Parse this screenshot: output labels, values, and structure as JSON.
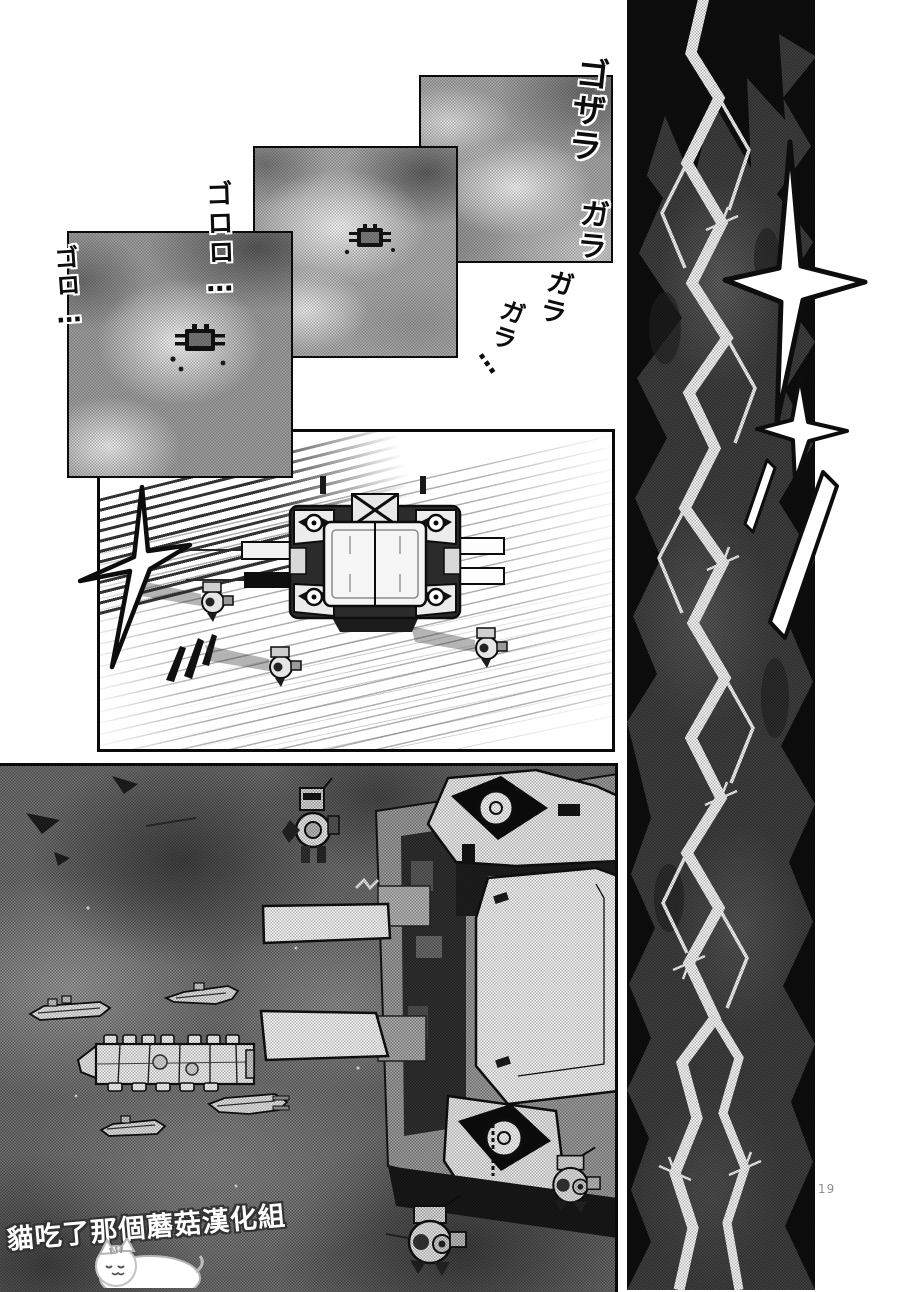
{
  "page": {
    "number": "19"
  },
  "watermark": {
    "text": "貓吃了那個蘑菇漢化組"
  },
  "sfx": {
    "crash_vertical": "ゴザラ",
    "rattle_1": "ガラ",
    "rattle_2": "ガラ",
    "rattle_3": "ガラ",
    "rattle_trail_dots": "…",
    "rumble_long": "ゴロロ…",
    "rumble_short": "ゴロ…"
  },
  "icons": {
    "sparkle": "four-point-star",
    "lightning": "jagged-white-bolt",
    "cargo_container": "top-down-pallet-box",
    "drone": "round-pod-robot",
    "cat_mascot": "lying-white-cat"
  },
  "colors": {
    "ink": "#0d0d0d",
    "paper": "#ffffff",
    "halftone_light": "#ababab",
    "halftone_mid": "#6e6e6e",
    "panel_black": "#0b0b0b"
  }
}
